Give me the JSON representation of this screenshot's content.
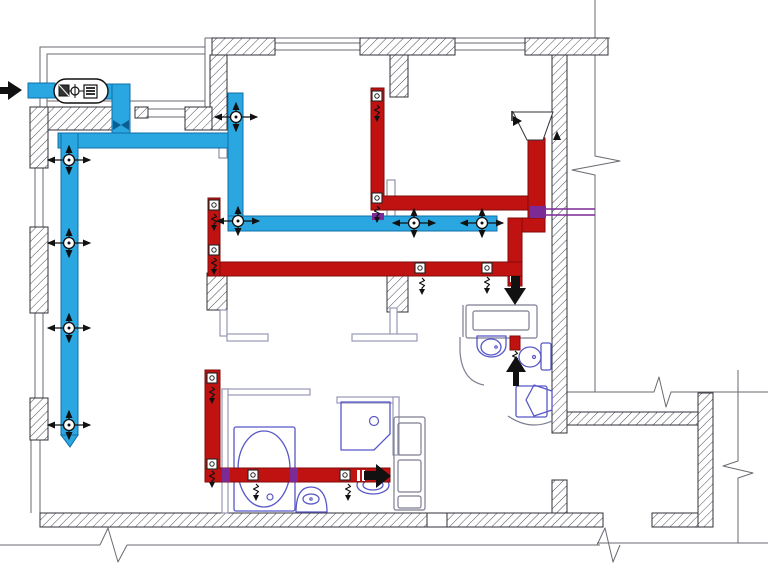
{
  "meta": {
    "title": "apartment-ventilation-floor-plan",
    "canvas": {
      "w": 768,
      "h": 569
    },
    "legend": {
      "supply_system": "blue-supply-ductwork",
      "exhaust_system": "red-exhaust-ductwork"
    }
  },
  "colors": {
    "supply_blue": "#2aa7e0",
    "supply_blue_edge": "#0f6fa9",
    "damper_blue": "#0b5e93",
    "exhaust_red": "#c11212",
    "exhaust_red_edge": "#7e0b0b",
    "overlap_purple": "#7b2a96",
    "fixture_purple": "#5757c8",
    "fixture_gray": "#7d7d92",
    "partition_gray": "#9898b8",
    "wall_stroke": "#2f2f38",
    "hatch_line": "#4a4a55",
    "thin_line": "#6a6a72",
    "black": "#111111",
    "white": "#ffffff"
  },
  "layers": {
    "walls": [
      [
        212,
        38,
        63,
        17
      ],
      [
        360,
        38,
        95,
        17
      ],
      [
        525,
        38,
        83,
        17
      ],
      [
        390,
        55,
        18,
        42
      ],
      [
        210,
        55,
        17,
        75
      ],
      [
        552,
        55,
        15,
        378
      ],
      [
        698,
        393,
        15,
        134
      ],
      [
        552,
        480,
        15,
        47
      ],
      [
        567,
        412,
        131,
        13
      ],
      [
        207,
        273,
        20,
        37
      ],
      [
        387,
        273,
        21,
        39
      ],
      [
        39,
        107,
        91,
        23
      ],
      [
        185,
        107,
        27,
        23
      ],
      [
        135,
        107,
        13,
        11
      ],
      [
        30,
        107,
        18,
        61
      ],
      [
        30,
        227,
        18,
        86
      ],
      [
        30,
        398,
        18,
        42
      ],
      [
        40,
        513,
        387,
        14
      ],
      [
        447,
        513,
        156,
        14
      ],
      [
        652,
        513,
        46,
        14
      ]
    ],
    "white_blocks": [
      [
        427,
        513,
        20,
        14
      ]
    ],
    "windows": [
      [
        275,
        43,
        360,
        43
      ],
      [
        275,
        50,
        360,
        50
      ],
      [
        455,
        43,
        525,
        43
      ],
      [
        455,
        50,
        525,
        50
      ],
      [
        35,
        168,
        35,
        227
      ],
      [
        43,
        168,
        43,
        227
      ],
      [
        35,
        313,
        35,
        398
      ],
      [
        43,
        313,
        43,
        398
      ],
      [
        31,
        440,
        31,
        513
      ],
      [
        40,
        440,
        40,
        513
      ],
      [
        148,
        109,
        185,
        109
      ],
      [
        148,
        117,
        185,
        117
      ]
    ],
    "thin_lines": [
      [
        205,
        38,
        610,
        38
      ],
      [
        205,
        38,
        205,
        107
      ],
      [
        595,
        0,
        595,
        150
      ],
      [
        595,
        177,
        595,
        392
      ],
      [
        567,
        392,
        648,
        392
      ],
      [
        675,
        392,
        768,
        392
      ],
      [
        738,
        370,
        738,
        455
      ],
      [
        738,
        480,
        738,
        543
      ],
      [
        597,
        543,
        768,
        543
      ],
      [
        0,
        545,
        100,
        545
      ],
      [
        127,
        545,
        600,
        545
      ],
      [
        47,
        101,
        205,
        101
      ]
    ],
    "balcony_paths": [
      "M40,107 L40,47 L205,47",
      "M47,107 L47,54 L205,54"
    ],
    "break_paths": [
      "M595,150 L595,156 L620,161 L572,170 L595,175 L595,177",
      "M648,392 L654,392 L659,377 L666,407 L671,392 L675,392",
      "M738,455 L738,461 L723,466 L753,473 L738,478 L738,480",
      "M100,545 L108,528 L118,562 L127,545",
      "M597,545 L605,528 L613,562 L620,545"
    ],
    "partitions": [
      [
        222,
        389,
        88,
        6
      ],
      [
        222,
        389,
        6,
        124
      ],
      [
        337,
        397,
        62,
        6
      ],
      [
        393,
        397,
        6,
        58
      ],
      [
        390,
        308,
        7,
        28
      ],
      [
        352,
        334,
        65,
        7
      ],
      [
        220,
        310,
        7,
        26
      ],
      [
        227,
        334,
        41,
        7
      ]
    ],
    "chases": [
      [
        219,
        140,
        8,
        18
      ],
      [
        387,
        180,
        8,
        42
      ]
    ],
    "blue_ducts": [
      [
        28,
        83,
        27,
        15
      ],
      [
        105,
        84,
        25,
        15
      ],
      [
        112,
        84,
        18,
        56
      ],
      [
        58,
        133,
        170,
        15
      ],
      [
        61,
        133,
        17,
        302
      ],
      [
        228,
        93,
        15,
        137
      ],
      [
        228,
        216,
        269,
        15
      ]
    ],
    "blue_tip": "61,435 78,435 70,447",
    "bowtie": [
      "113,120 121,125 113,130",
      "129,120 121,125 129,130"
    ],
    "red_ducts": [
      [
        371,
        88,
        13,
        122
      ],
      [
        371,
        196,
        174,
        14
      ],
      [
        528,
        138,
        17,
        94
      ],
      [
        508,
        218,
        37,
        14
      ],
      [
        508,
        218,
        14,
        68
      ],
      [
        208,
        262,
        314,
        14
      ],
      [
        208,
        198,
        12,
        78
      ],
      [
        205,
        370,
        15,
        112
      ],
      [
        205,
        468,
        185,
        14
      ],
      [
        510,
        336,
        10,
        14
      ]
    ],
    "purple_blocks": [
      [
        372,
        213,
        12,
        7
      ],
      [
        530,
        206,
        16,
        12
      ],
      [
        222,
        468,
        8,
        14
      ],
      [
        290,
        468,
        8,
        14
      ]
    ],
    "purple_lines": [
      [
        546,
        209,
        595,
        209
      ],
      [
        546,
        215,
        595,
        215
      ]
    ],
    "diffusers": [
      [
        69,
        160
      ],
      [
        69,
        243
      ],
      [
        69,
        328
      ],
      [
        69,
        425
      ],
      [
        236,
        117
      ],
      [
        238,
        221
      ],
      [
        414,
        223
      ],
      [
        482,
        223
      ]
    ],
    "grilles": [
      [
        377,
        96
      ],
      [
        377,
        198
      ],
      [
        214,
        205
      ],
      [
        214,
        250
      ],
      [
        420,
        268
      ],
      [
        487,
        268
      ],
      [
        212,
        378
      ],
      [
        212,
        464
      ],
      [
        253,
        475
      ],
      [
        345,
        475
      ]
    ],
    "zigzags": [
      [
        377,
        105
      ],
      [
        377,
        206
      ],
      [
        214,
        214
      ],
      [
        214,
        258
      ],
      [
        422,
        278
      ],
      [
        487,
        277
      ],
      [
        212,
        387
      ],
      [
        212,
        471
      ],
      [
        256,
        484
      ],
      [
        348,
        484
      ],
      [
        515,
        351
      ]
    ],
    "white_ticks": [
      [
        510,
        276,
        3,
        6
      ],
      [
        516,
        276,
        3,
        6
      ],
      [
        357,
        470,
        3,
        11
      ],
      [
        362,
        470,
        3,
        11
      ]
    ],
    "black_arrows": [
      {
        "name": "outdoor-air-intake-arrow",
        "shaft": [
          0,
          87,
          9,
          7
        ],
        "head": "8,81 8,100 22,90"
      },
      {
        "name": "exhaust-shaft-down-arrow",
        "shaft": [
          511,
          276,
          9,
          14
        ],
        "head": "504,288 526,288 515,305"
      },
      {
        "name": "exhaust-right-arrow",
        "shaft": [
          364,
          471,
          12,
          9
        ],
        "head": "376,464 376,488 391,476"
      },
      {
        "name": "exhaust-up-arrow",
        "shaft": [
          513,
          372,
          6,
          14
        ],
        "head": "506,372 526,372 516,356"
      },
      {
        "name": "wall-vent-arrow",
        "head": "553,140 561,140 557,131"
      },
      {
        "name": "hood-flow-arrow",
        "head": "513,116 513,126 522,121",
        "line": [
          512,
          111,
          512,
          121
        ]
      }
    ],
    "ahu": {
      "capsule": [
        54,
        79,
        54,
        24
      ],
      "fan": [
        59,
        85,
        10,
        11
      ],
      "valve_circle": [
        75,
        91,
        4
      ],
      "valve_line": [
        75,
        84,
        75,
        98
      ],
      "links": [
        [
          69,
          91,
          71,
          91
        ],
        [
          79,
          91,
          84,
          91
        ]
      ],
      "heater": [
        84,
        85,
        13,
        13
      ],
      "heater_bars": [
        [
          86,
          88,
          95,
          88
        ],
        [
          86,
          91,
          95,
          91
        ],
        [
          86,
          94,
          95,
          94
        ]
      ]
    },
    "hood_poly": "513,112 553,112 543,140 527,140",
    "fixtures_purple": {
      "rects": [
        [
          234,
          427,
          61,
          84
        ],
        [
          541,
          343,
          10,
          27
        ],
        [
          516,
          386,
          31,
          31
        ]
      ],
      "ellipses": [
        [
          264,
          469,
          26,
          38
        ],
        [
          311,
          499,
          8,
          5
        ],
        [
          530,
          357,
          11,
          10
        ],
        [
          491,
          347,
          10,
          8
        ],
        [
          373,
          485,
          16,
          9
        ],
        [
          373,
          485,
          10,
          5
        ]
      ],
      "circles": [
        [
          270,
          497,
          3
        ],
        [
          534,
          357,
          1.5
        ],
        [
          496,
          347,
          1.2
        ],
        [
          374,
          421,
          4.5
        ],
        [
          311,
          499,
          1.2
        ]
      ],
      "paths": [
        "M296,512 C296,494 302,487 311,487 C320,487 327,494 327,512 Z",
        "M341,402 H390 V434 L374,450 H341 Z",
        "M477,336 h29 v9 a14.5,12 0 0 1 -29,0 Z",
        "M534,385 L552,391 L552,410 L534,416 L526,400 Z"
      ]
    },
    "fixtures_gray": {
      "rects": [
        [
          466,
          305,
          71,
          33
        ],
        [
          473,
          311,
          56,
          19
        ],
        [
          394,
          417,
          31,
          93
        ],
        [
          398,
          423,
          23,
          32
        ],
        [
          398,
          460,
          23,
          32
        ],
        [
          398,
          496,
          23,
          12
        ]
      ],
      "paths": [
        "M460,337 L460,352 Q462,381 484,385",
        "M508,416 Q530,431 552,421",
        "M463,305 L463,337"
      ]
    }
  }
}
